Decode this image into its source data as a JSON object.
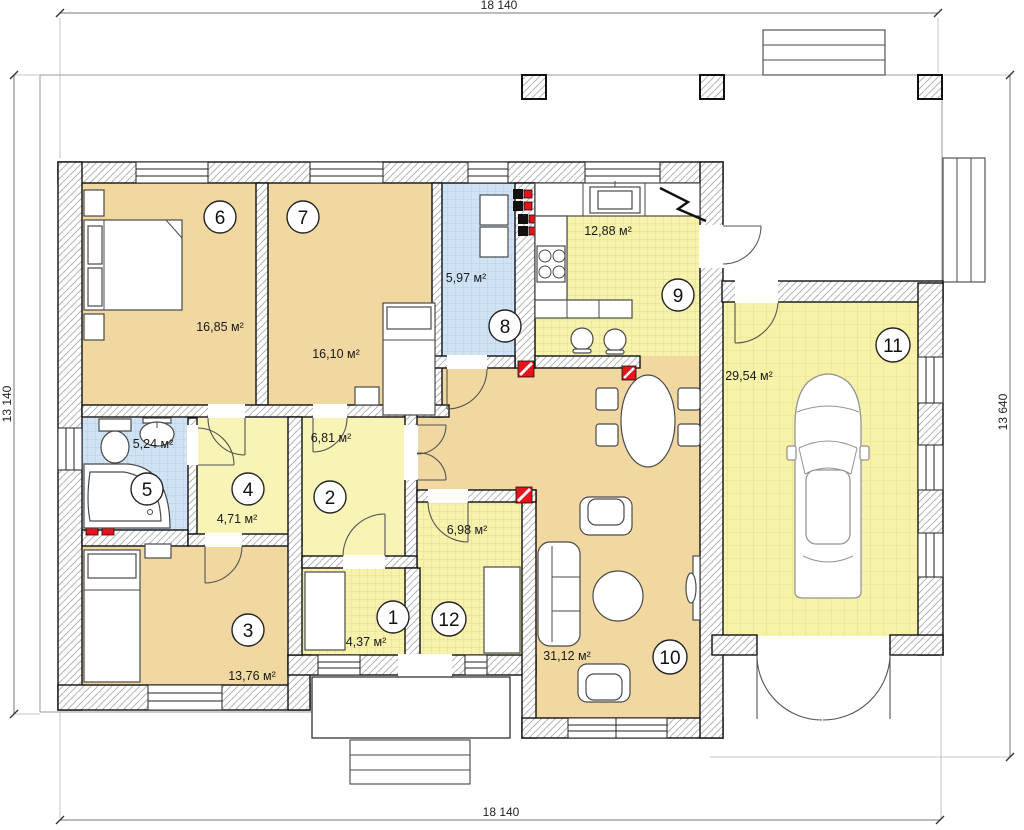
{
  "plan": {
    "type": "floor-plan",
    "dimensions": {
      "top": "18 140",
      "bottom": "18 140",
      "left": "13 140",
      "right": "13 640"
    },
    "rooms": [
      {
        "number": "1",
        "area": "4,37 м²"
      },
      {
        "number": "2",
        "area": "6,81 м²"
      },
      {
        "number": "3",
        "area": "13,76 м²"
      },
      {
        "number": "4",
        "area": "4,71 м²"
      },
      {
        "number": "5",
        "area": "5,24 м²"
      },
      {
        "number": "6",
        "area": "16,85 м²"
      },
      {
        "number": "7",
        "area": "16,10 м²"
      },
      {
        "number": "8",
        "area": "5,97 м²"
      },
      {
        "number": "9",
        "area": "12,88 м²"
      },
      {
        "number": "10",
        "area": "31,12 м²"
      },
      {
        "number": "11",
        "area": "29,54 м²"
      },
      {
        "number": "12",
        "area": "6,98 м²"
      }
    ],
    "colors": {
      "room_fill_tan": "#f0d8a0",
      "room_fill_pale_yellow": "#f8f4b6",
      "tile_yellow": "#f7f3ac",
      "tile_blue": "#cfe3f5",
      "garage_tile": "#f6f2a8",
      "vent_red": "#e8131a"
    }
  }
}
